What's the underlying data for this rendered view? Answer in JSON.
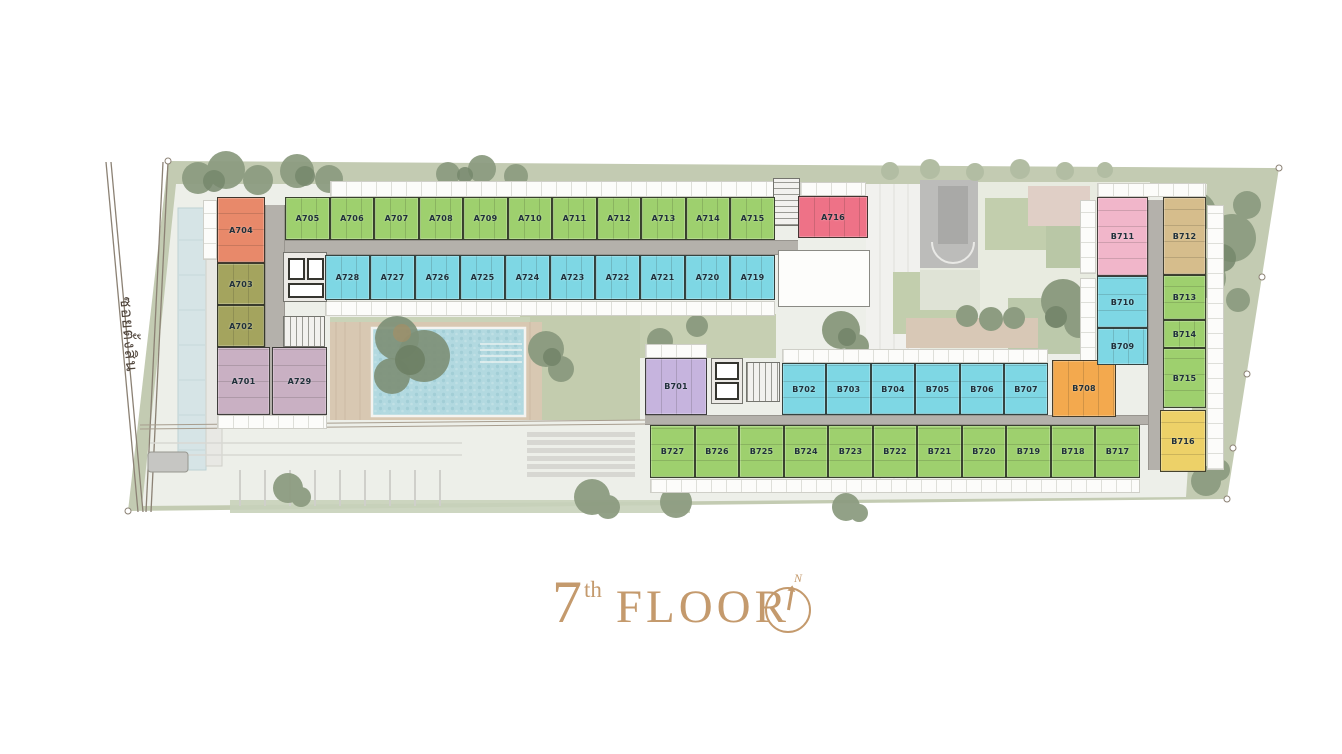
{
  "title": {
    "number": "7",
    "ordinal": "th",
    "word": "FLOOR"
  },
  "compass": {
    "north": "N"
  },
  "road": {
    "name": "ซอยตั้งสิน"
  },
  "colors": {
    "accent": "#c49a6d",
    "corridor": "#b4b1ab",
    "landscape": "#c3cbb2",
    "pool": "#b2d9e0",
    "units": {
      "green": "#9ed06e",
      "cyan": "#7ed7e4",
      "salmon": "#e8896a",
      "olive": "#a4a45e",
      "mauve": "#c9b0c3",
      "pinkred": "#ee7287",
      "purple": "#c6b4de",
      "orange": "#f3a94e",
      "pink": "#f1b6ca",
      "tan": "#d6bd8c",
      "yellow": "#edd168"
    }
  },
  "buildings": {
    "A": {
      "units": [
        {
          "label": "A704",
          "color": "salmon",
          "rect": [
            217,
            197,
            48,
            66
          ]
        },
        {
          "label": "A703",
          "color": "olive",
          "rect": [
            217,
            263,
            48,
            42
          ]
        },
        {
          "label": "A702",
          "color": "olive",
          "rect": [
            217,
            305,
            48,
            42
          ]
        },
        {
          "label": "A701",
          "color": "mauve",
          "rect": [
            217,
            347,
            53,
            68
          ]
        },
        {
          "label": "A729",
          "color": "mauve",
          "rect": [
            272,
            347,
            55,
            68
          ]
        },
        {
          "label": "A705",
          "color": "green",
          "rect": [
            285,
            197,
            45,
            43
          ]
        },
        {
          "label": "A706",
          "color": "green",
          "rect": [
            330,
            197,
            44,
            43
          ]
        },
        {
          "label": "A707",
          "color": "green",
          "rect": [
            374,
            197,
            45,
            43
          ]
        },
        {
          "label": "A708",
          "color": "green",
          "rect": [
            419,
            197,
            44,
            43
          ]
        },
        {
          "label": "A709",
          "color": "green",
          "rect": [
            463,
            197,
            45,
            43
          ]
        },
        {
          "label": "A710",
          "color": "green",
          "rect": [
            508,
            197,
            44,
            43
          ]
        },
        {
          "label": "A711",
          "color": "green",
          "rect": [
            552,
            197,
            45,
            43
          ]
        },
        {
          "label": "A712",
          "color": "green",
          "rect": [
            597,
            197,
            44,
            43
          ]
        },
        {
          "label": "A713",
          "color": "green",
          "rect": [
            641,
            197,
            45,
            43
          ]
        },
        {
          "label": "A714",
          "color": "green",
          "rect": [
            686,
            197,
            44,
            43
          ]
        },
        {
          "label": "A715",
          "color": "green",
          "rect": [
            730,
            197,
            45,
            43
          ]
        },
        {
          "label": "A716",
          "color": "pinkred",
          "rect": [
            798,
            196,
            70,
            42
          ]
        },
        {
          "label": "A728",
          "color": "cyan",
          "rect": [
            325,
            255,
            45,
            45
          ]
        },
        {
          "label": "A727",
          "color": "cyan",
          "rect": [
            370,
            255,
            45,
            45
          ]
        },
        {
          "label": "A726",
          "color": "cyan",
          "rect": [
            415,
            255,
            45,
            45
          ]
        },
        {
          "label": "A725",
          "color": "cyan",
          "rect": [
            460,
            255,
            45,
            45
          ]
        },
        {
          "label": "A724",
          "color": "cyan",
          "rect": [
            505,
            255,
            45,
            45
          ]
        },
        {
          "label": "A723",
          "color": "cyan",
          "rect": [
            550,
            255,
            45,
            45
          ]
        },
        {
          "label": "A722",
          "color": "cyan",
          "rect": [
            595,
            255,
            45,
            45
          ]
        },
        {
          "label": "A721",
          "color": "cyan",
          "rect": [
            640,
            255,
            45,
            45
          ]
        },
        {
          "label": "A720",
          "color": "cyan",
          "rect": [
            685,
            255,
            45,
            45
          ]
        },
        {
          "label": "A719",
          "color": "cyan",
          "rect": [
            730,
            255,
            45,
            45
          ]
        }
      ]
    },
    "B": {
      "units": [
        {
          "label": "B701",
          "color": "purple",
          "rect": [
            645,
            358,
            62,
            57
          ]
        },
        {
          "label": "B702",
          "color": "cyan",
          "rect": [
            782,
            363,
            44,
            52
          ]
        },
        {
          "label": "B703",
          "color": "cyan",
          "rect": [
            826,
            363,
            45,
            52
          ]
        },
        {
          "label": "B704",
          "color": "cyan",
          "rect": [
            871,
            363,
            44,
            52
          ]
        },
        {
          "label": "B705",
          "color": "cyan",
          "rect": [
            915,
            363,
            45,
            52
          ]
        },
        {
          "label": "B706",
          "color": "cyan",
          "rect": [
            960,
            363,
            44,
            52
          ]
        },
        {
          "label": "B707",
          "color": "cyan",
          "rect": [
            1004,
            363,
            44,
            52
          ]
        },
        {
          "label": "B708",
          "color": "orange",
          "rect": [
            1052,
            360,
            64,
            57
          ]
        },
        {
          "label": "B711",
          "color": "pink",
          "rect": [
            1097,
            197,
            51,
            79
          ]
        },
        {
          "label": "B712",
          "color": "tan",
          "rect": [
            1163,
            197,
            43,
            78
          ]
        },
        {
          "label": "B710",
          "color": "cyan",
          "rect": [
            1097,
            276,
            51,
            52
          ]
        },
        {
          "label": "B709",
          "color": "cyan",
          "rect": [
            1097,
            328,
            51,
            37
          ]
        },
        {
          "label": "B713",
          "color": "green",
          "rect": [
            1163,
            275,
            43,
            45
          ]
        },
        {
          "label": "B714",
          "color": "green",
          "rect": [
            1163,
            320,
            43,
            28
          ]
        },
        {
          "label": "B715",
          "color": "green",
          "rect": [
            1163,
            348,
            43,
            60
          ]
        },
        {
          "label": "B716",
          "color": "yellow",
          "rect": [
            1160,
            410,
            46,
            62
          ]
        },
        {
          "label": "B727",
          "color": "green",
          "rect": [
            650,
            425,
            45,
            53
          ]
        },
        {
          "label": "B726",
          "color": "green",
          "rect": [
            695,
            425,
            44,
            53
          ]
        },
        {
          "label": "B725",
          "color": "green",
          "rect": [
            739,
            425,
            45,
            53
          ]
        },
        {
          "label": "B724",
          "color": "green",
          "rect": [
            784,
            425,
            44,
            53
          ]
        },
        {
          "label": "B723",
          "color": "green",
          "rect": [
            828,
            425,
            45,
            53
          ]
        },
        {
          "label": "B722",
          "color": "green",
          "rect": [
            873,
            425,
            44,
            53
          ]
        },
        {
          "label": "B721",
          "color": "green",
          "rect": [
            917,
            425,
            45,
            53
          ]
        },
        {
          "label": "B720",
          "color": "green",
          "rect": [
            962,
            425,
            44,
            53
          ]
        },
        {
          "label": "B719",
          "color": "green",
          "rect": [
            1006,
            425,
            45,
            53
          ]
        },
        {
          "label": "B718",
          "color": "green",
          "rect": [
            1051,
            425,
            44,
            53
          ]
        },
        {
          "label": "B717",
          "color": "green",
          "rect": [
            1095,
            425,
            45,
            53
          ]
        }
      ]
    }
  }
}
